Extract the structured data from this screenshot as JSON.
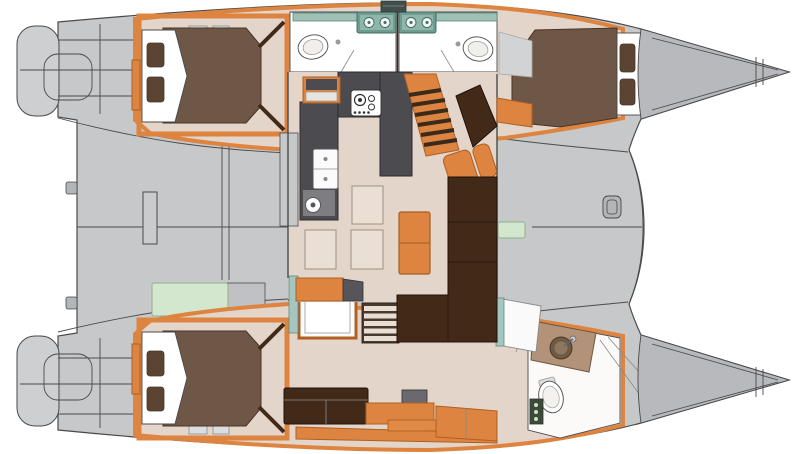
{
  "diagram": {
    "label": "catamaran-floor-plan",
    "type": "boat-floor-plan",
    "orientation": "bow-right",
    "rooms": [
      {
        "name": "aft-cockpit",
        "features": [
          "cockpit-table",
          "bench-green-cushion"
        ]
      },
      {
        "name": "salon",
        "features": [
          "u-shaped-galley",
          "gas-stove",
          "double-sink",
          "round-sink",
          "dinette-table",
          "l-shaped-sofa",
          "orange-chair",
          "floor-cushions",
          "stairs-to-upper-hull"
        ]
      },
      {
        "name": "upper-hull-aft-cabin",
        "features": [
          "double-berth",
          "two-pillows"
        ]
      },
      {
        "name": "upper-hull-head-left",
        "features": [
          "vanity-twin-basins",
          "shower-tray"
        ]
      },
      {
        "name": "upper-hull-head-right",
        "features": [
          "vanity-twin-basins",
          "shower-tray"
        ]
      },
      {
        "name": "upper-hull-forward-cabin",
        "features": [
          "double-berth",
          "two-pillows"
        ]
      },
      {
        "name": "lower-hull-aft-cabin",
        "features": [
          "double-berth",
          "two-pillows"
        ]
      },
      {
        "name": "lower-hull-lounge",
        "features": [
          "sofa",
          "tv-unit",
          "desk",
          "cabinet",
          "shower-box",
          "stairs-to-lower-hull"
        ]
      },
      {
        "name": "lower-hull-forward-head",
        "features": [
          "vanity-counter",
          "round-basin",
          "toilet",
          "shelf"
        ]
      },
      {
        "name": "foredeck",
        "features": [
          "deck-fitting",
          "side-seat-green-cushion"
        ]
      }
    ]
  },
  "colors": {
    "deck-gray": "#c6c8ca",
    "cap-gray": "#cdcfd1",
    "bow-gray": "#b7b9bd",
    "line": "#4a4a4a",
    "line-dark": "#303030",
    "floor-beige": "#e3d5ca",
    "cushion-beige": "#eadfd5",
    "wood-orange": "#dd8440",
    "wood-orange-dark": "#b06023",
    "mattress-brown": "#6f5747",
    "pillow-brown": "#5c4433",
    "sofa-brown": "#432a18",
    "galley-charcoal": "#4b4b50",
    "galley-light": "#7d7d82",
    "vanity-teal": "#9fc0b4",
    "vanity-teal-dark": "#5d8a80",
    "glass-teal": "#a5c6c0",
    "cushion-green": "#d3e7cf",
    "counter-tan": "#b2937a",
    "white": "#ffffff",
    "hatch-gray": "#dcdde0"
  }
}
